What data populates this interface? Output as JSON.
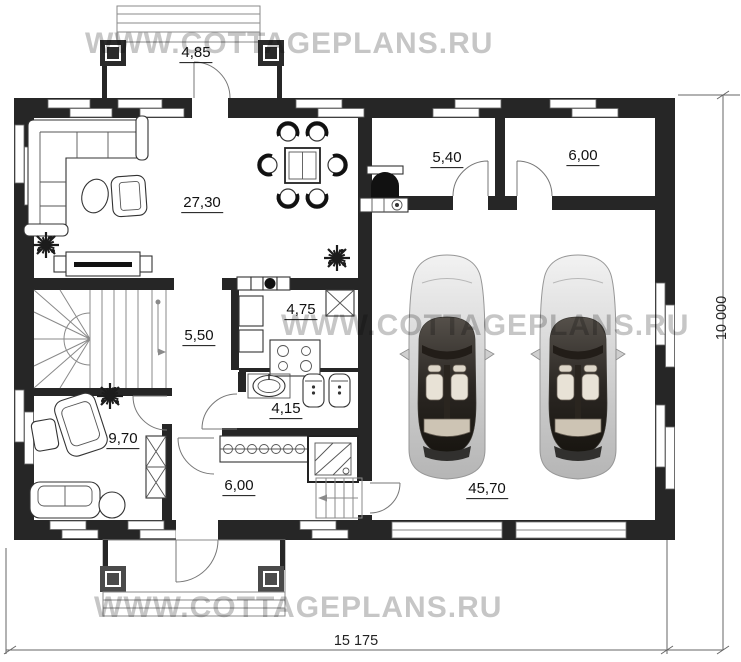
{
  "watermarks": {
    "top": "WWW.COTTAGEPLANS.RU",
    "middle": "WWW.COTTAGEPLANS.RU",
    "bottom": "WWW.COTTAGEPLANS.RU"
  },
  "rooms": {
    "terrace": {
      "area": "4,85"
    },
    "living": {
      "area": "27,30"
    },
    "boiler": {
      "area": "5,40"
    },
    "storage": {
      "area": "6,00"
    },
    "hall": {
      "area": "5,50"
    },
    "kitchen": {
      "area": "4,75"
    },
    "bathroom": {
      "area": "4,15"
    },
    "study": {
      "area": "9,70"
    },
    "entry": {
      "area": "6,00"
    },
    "garage": {
      "area": "45,70"
    }
  },
  "dimensions": {
    "width": "15 175",
    "height": "10 000"
  },
  "colors": {
    "wall": "#262626",
    "watermark": "#c6c6c6",
    "furniture_line": "#333333",
    "dimension_line": "#666666"
  }
}
